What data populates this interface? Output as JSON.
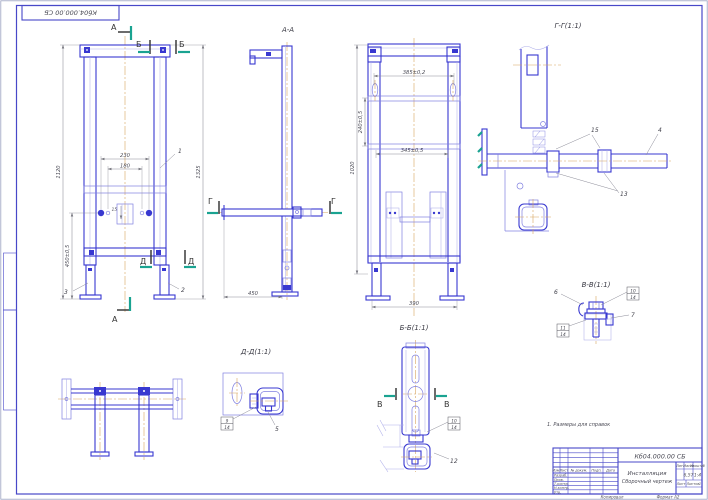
{
  "sheet": {
    "note": "1. Размеры для справок",
    "kopiroval": "Копировал",
    "format_label": "Формат А2"
  },
  "section_labels": {
    "aa": "А-А",
    "bb": "Б-Б(1:1)",
    "vv": "В-В(1:1)",
    "gg": "Г-Г(1:1)",
    "dd": "Д-Д(1:1)"
  },
  "section_marks": {
    "a": "А",
    "b": "Б",
    "v": "В",
    "g": "Г",
    "d": "Д"
  },
  "dimensions": {
    "front_width_outer": "230",
    "front_width_inner": "180",
    "front_height_total": "1120",
    "front_height_lower": "450±0,5",
    "front_height_right": "1325",
    "front_offset_small": "15",
    "aa_depth": "450",
    "bb_width_top": "385±0,2",
    "bb_width_mid": "345±0,5",
    "bb_width_feet": "390",
    "bb_height_rails": "240±0,5",
    "bb_height_outer": "1020"
  },
  "callouts": {
    "pos1": "1",
    "pos2": "2",
    "pos3": "3",
    "pos4": "4",
    "pos5": "5",
    "pos6": "6",
    "pos7": "7",
    "pos9": "9",
    "pos10": "10",
    "pos11": "11",
    "pos12": "12",
    "pos13": "13",
    "pos15": "15",
    "qty14": "14"
  },
  "title_block": {
    "designation": "Кб04.000.00 СБ",
    "name_line1": "Инсталляция",
    "name_line2": "Сборочный чертеж",
    "col_izm": "Изм.",
    "col_list": "Лист",
    "col_doc": "№ докум.",
    "col_podp": "Подп.",
    "col_data": "Дата",
    "row_razrab": "Разраб.",
    "row_prov": "Пров.",
    "row_tkontr": "Т.контр.",
    "row_nkontr": "Н.контр.",
    "row_utv": "Утв.",
    "hdr_lit": "Лит.",
    "hdr_massa": "Масса",
    "hdr_masshtab": "Масштаб",
    "val_massa": "6,57",
    "val_masshtab": "1:4",
    "lbl_list": "Лист",
    "lbl_listov": "Листов",
    "val_listov": "1"
  },
  "colors": {
    "line_main": "#3838d0",
    "line_light": "#8080e0",
    "dimension": "#8a8a97",
    "centerline": "#d8a55f",
    "section_arrow": "#1aa391",
    "frame": "#4848c8"
  }
}
